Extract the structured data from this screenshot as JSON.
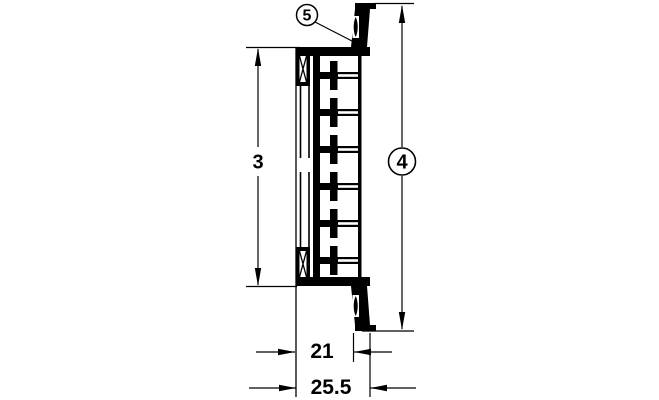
{
  "drawing": {
    "description": "technical cross-section drawing of a louvered ventilation grille profile with dimension callouts",
    "ink_color": "#000000",
    "background_color": "#ffffff",
    "callouts": {
      "inner_height_ref": "3",
      "overall_height_ref": "4",
      "seal_ref": "5"
    },
    "dimensions": {
      "inner_width": "21",
      "overall_width": "25.5"
    }
  }
}
